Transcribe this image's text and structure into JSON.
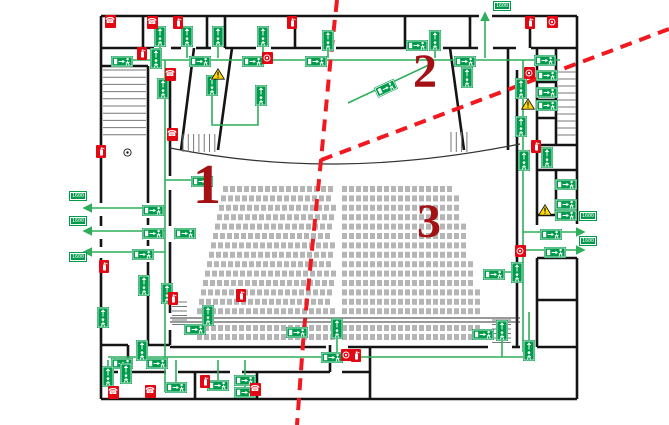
{
  "plan": {
    "title": "theater-evacuation-floor-plan",
    "colors": {
      "wall": "#141414",
      "route_green": "#2EAE5B",
      "sign_green": "#009B4A",
      "equipment_red": "#E30613",
      "section_red": "#F1191F",
      "zone_number_red": "#A31115",
      "seat_gray": "#B5B5B5",
      "warning_yellow": "#FFD800",
      "stair_gray": "#777777"
    },
    "zones": [
      {
        "label": "1",
        "x": 193,
        "y": 160,
        "size": 56
      },
      {
        "label": "2",
        "x": 413,
        "y": 50,
        "size": 48
      },
      {
        "label": "3",
        "x": 417,
        "y": 200,
        "size": 48
      }
    ],
    "width_labels": [
      {
        "text": "1600",
        "x": 70,
        "y": 192
      },
      {
        "text": "1600",
        "x": 70,
        "y": 217
      },
      {
        "text": "1600",
        "x": 70,
        "y": 253
      },
      {
        "text": "1600",
        "x": 580,
        "y": 212
      },
      {
        "text": "1600",
        "x": 580,
        "y": 237
      },
      {
        "text": "1600",
        "x": 494,
        "y": 2
      }
    ],
    "signs": {
      "horizontal": [
        [
          122,
          59
        ],
        [
          200,
          59
        ],
        [
          253,
          59
        ],
        [
          316,
          59
        ],
        [
          417,
          43
        ],
        [
          465,
          59
        ],
        [
          545,
          58
        ],
        [
          153,
          208
        ],
        [
          153,
          231
        ],
        [
          143,
          252
        ],
        [
          185,
          231
        ],
        [
          202,
          179
        ],
        [
          195,
          327
        ],
        [
          297,
          330
        ],
        [
          122,
          361
        ],
        [
          157,
          361
        ],
        [
          176,
          385
        ],
        [
          218,
          383
        ],
        [
          245,
          378
        ],
        [
          245,
          390
        ],
        [
          332,
          355
        ],
        [
          483,
          332
        ],
        [
          494,
          272
        ],
        [
          547,
          73
        ],
        [
          547,
          90
        ],
        [
          547,
          103
        ],
        [
          566,
          182
        ],
        [
          566,
          202
        ],
        [
          566,
          213
        ],
        [
          551,
          232
        ],
        [
          555,
          250
        ]
      ],
      "rotated": [
        {
          "x": 385,
          "y": 86,
          "rot": -25
        }
      ],
      "vertical": [
        [
          160,
          36
        ],
        [
          187,
          36
        ],
        [
          218,
          36
        ],
        [
          263,
          36
        ],
        [
          328,
          40
        ],
        [
          435,
          40
        ],
        [
          156,
          58
        ],
        [
          467,
          77
        ],
        [
          521,
          88
        ],
        [
          521,
          126
        ],
        [
          524,
          160
        ],
        [
          547,
          157
        ],
        [
          212,
          85
        ],
        [
          261,
          95
        ],
        [
          163,
          88
        ],
        [
          144,
          285
        ],
        [
          103,
          317
        ],
        [
          167,
          293
        ],
        [
          208,
          315
        ],
        [
          142,
          350
        ],
        [
          108,
          376
        ],
        [
          126,
          373
        ],
        [
          337,
          328
        ],
        [
          502,
          330
        ],
        [
          529,
          350
        ],
        [
          517,
          272
        ]
      ]
    },
    "icons": {
      "phone": [
        [
          110,
          21
        ],
        [
          152,
          22
        ],
        [
          170,
          74
        ],
        [
          172,
          134
        ],
        [
          113,
          392
        ],
        [
          150,
          391
        ],
        [
          255,
          389
        ]
      ],
      "extinguisher": [
        [
          178,
          22
        ],
        [
          292,
          22
        ],
        [
          142,
          53
        ],
        [
          101,
          151
        ],
        [
          104,
          266
        ],
        [
          173,
          298
        ],
        [
          241,
          295
        ],
        [
          356,
          355
        ],
        [
          530,
          22
        ],
        [
          536,
          146
        ],
        [
          205,
          381
        ]
      ],
      "alarm": [
        [
          267,
          58
        ],
        [
          529,
          73
        ],
        [
          552,
          22
        ],
        [
          520,
          251
        ],
        [
          346,
          355
        ]
      ],
      "warning": [
        [
          218,
          74
        ],
        [
          528,
          104
        ],
        [
          545,
          210
        ]
      ],
      "callpoint": [
        [
          127,
          152
        ]
      ]
    },
    "routes": [
      {
        "points": [
          [
            112,
            60
          ],
          [
            560,
            60
          ]
        ]
      },
      {
        "points": [
          [
            160,
            58
          ],
          [
            160,
            46
          ]
        ]
      },
      {
        "points": [
          [
            187,
            58
          ],
          [
            187,
            46
          ]
        ]
      },
      {
        "points": [
          [
            218,
            58
          ],
          [
            218,
            46
          ]
        ]
      },
      {
        "points": [
          [
            263,
            58
          ],
          [
            263,
            46
          ]
        ]
      },
      {
        "points": [
          [
            328,
            58
          ],
          [
            328,
            50
          ]
        ]
      },
      {
        "points": [
          [
            435,
            58
          ],
          [
            435,
            50
          ]
        ]
      },
      {
        "points": [
          [
            467,
            60
          ],
          [
            467,
            70
          ]
        ]
      },
      {
        "points": [
          [
            485,
            58
          ],
          [
            485,
            13
          ]
        ],
        "arrow": true
      },
      {
        "points": [
          [
            523,
            60
          ],
          [
            523,
            352
          ]
        ]
      },
      {
        "points": [
          [
            165,
            60
          ],
          [
            165,
            392
          ]
        ]
      },
      {
        "points": [
          [
            165,
            208
          ],
          [
            84,
            208
          ]
        ],
        "arrow": true
      },
      {
        "points": [
          [
            165,
            231
          ],
          [
            84,
            231
          ]
        ],
        "arrow": true
      },
      {
        "points": [
          [
            165,
            252
          ],
          [
            84,
            252
          ]
        ],
        "arrow": true
      },
      {
        "points": [
          [
            523,
            232
          ],
          [
            584,
            232
          ]
        ],
        "arrow": true
      },
      {
        "points": [
          [
            523,
            250
          ],
          [
            584,
            250
          ]
        ],
        "arrow": true
      },
      {
        "points": [
          [
            165,
            180
          ],
          [
            202,
            180
          ]
        ]
      },
      {
        "points": [
          [
            348,
            103
          ],
          [
            433,
            63
          ]
        ]
      },
      {
        "points": [
          [
            108,
            357
          ],
          [
            527,
            357
          ]
        ]
      },
      {
        "points": [
          [
            529,
            312
          ],
          [
            529,
            347
          ]
        ]
      },
      {
        "points": [
          [
            337,
            332
          ],
          [
            337,
            357
          ]
        ]
      },
      {
        "points": [
          [
            176,
            360
          ],
          [
            176,
            382
          ]
        ]
      },
      {
        "points": [
          [
            218,
            360
          ],
          [
            218,
            381
          ]
        ]
      },
      {
        "points": [
          [
            245,
            360
          ],
          [
            245,
            388
          ]
        ]
      },
      {
        "points": [
          [
            108,
            360
          ],
          [
            108,
            373
          ]
        ]
      },
      {
        "points": [
          [
            126,
            360
          ],
          [
            126,
            371
          ]
        ]
      },
      {
        "points": [
          [
            142,
            347
          ],
          [
            142,
            357
          ]
        ]
      },
      {
        "points": [
          [
            502,
            334
          ],
          [
            502,
            357
          ]
        ]
      },
      {
        "points": [
          [
            523,
            272
          ],
          [
            497,
            272
          ]
        ]
      },
      {
        "points": [
          [
            212,
            95
          ],
          [
            212,
            125
          ],
          [
            258,
            125
          ],
          [
            258,
            105
          ]
        ]
      }
    ],
    "section_lines": [
      {
        "points": [
          [
            337,
            0
          ],
          [
            331,
            55
          ],
          [
            321,
            160
          ],
          [
            313,
            240
          ],
          [
            304,
            330
          ],
          [
            297,
            425
          ]
        ]
      },
      {
        "points": [
          [
            321,
            160
          ],
          [
            669,
            29
          ]
        ]
      }
    ],
    "walls": [
      [
        101,
        16,
        479,
        16
      ],
      [
        492,
        16,
        577,
        16
      ],
      [
        101,
        16,
        101,
        203
      ],
      [
        101,
        216,
        101,
        226
      ],
      [
        101,
        239,
        101,
        247
      ],
      [
        101,
        258,
        101,
        399
      ],
      [
        577,
        16,
        577,
        224
      ],
      [
        577,
        258,
        577,
        399
      ],
      [
        101,
        399,
        577,
        399
      ],
      [
        101,
        48,
        154,
        48
      ],
      [
        171,
        48,
        181,
        48
      ],
      [
        196,
        48,
        211,
        48
      ],
      [
        225,
        48,
        256,
        48
      ],
      [
        271,
        48,
        321,
        48
      ],
      [
        336,
        48,
        428,
        48
      ],
      [
        443,
        48,
        478,
        48
      ],
      [
        493,
        48,
        516,
        48
      ],
      [
        531,
        48,
        577,
        48
      ],
      [
        143,
        16,
        143,
        48
      ],
      [
        207,
        16,
        207,
        48
      ],
      [
        225,
        16,
        225,
        48
      ],
      [
        295,
        16,
        295,
        48
      ],
      [
        405,
        16,
        405,
        48
      ],
      [
        470,
        16,
        470,
        48
      ],
      [
        530,
        16,
        530,
        48
      ],
      [
        101,
        66,
        148,
        66
      ],
      [
        148,
        66,
        148,
        143
      ],
      [
        148,
        143,
        148,
        203
      ],
      [
        148,
        218,
        148,
        225
      ],
      [
        148,
        240,
        148,
        246
      ],
      [
        148,
        262,
        148,
        345
      ],
      [
        170,
        70,
        170,
        176
      ],
      [
        170,
        190,
        170,
        226
      ],
      [
        170,
        242,
        170,
        288
      ],
      [
        170,
        304,
        170,
        313
      ],
      [
        170,
        330,
        170,
        345
      ],
      [
        194,
        48,
        181,
        150
      ],
      [
        232,
        48,
        218,
        150
      ],
      [
        450,
        48,
        464,
        150
      ],
      [
        508,
        48,
        508,
        150
      ],
      [
        517,
        70,
        517,
        266
      ],
      [
        517,
        282,
        517,
        347
      ],
      [
        170,
        347,
        326,
        347
      ],
      [
        348,
        347,
        488,
        347
      ],
      [
        512,
        347,
        520,
        347
      ],
      [
        537,
        347,
        577,
        347
      ],
      [
        537,
        48,
        537,
        225
      ],
      [
        537,
        258,
        537,
        347
      ],
      [
        537,
        82,
        556,
        82
      ],
      [
        537,
        100,
        556,
        100
      ],
      [
        537,
        118,
        556,
        118
      ],
      [
        556,
        48,
        556,
        145
      ],
      [
        537,
        145,
        577,
        145
      ],
      [
        537,
        170,
        577,
        170
      ],
      [
        556,
        170,
        556,
        215
      ],
      [
        537,
        215,
        577,
        215
      ],
      [
        537,
        258,
        577,
        258
      ],
      [
        537,
        300,
        577,
        300
      ],
      [
        101,
        345,
        128,
        345
      ],
      [
        140,
        345,
        170,
        345
      ],
      [
        101,
        372,
        118,
        372
      ],
      [
        130,
        372,
        166,
        372
      ],
      [
        178,
        372,
        230,
        372
      ],
      [
        242,
        372,
        330,
        372
      ],
      [
        342,
        372,
        370,
        372
      ],
      [
        128,
        345,
        128,
        372
      ],
      [
        195,
        372,
        195,
        399
      ],
      [
        257,
        372,
        257,
        399
      ],
      [
        370,
        347,
        370,
        399
      ],
      [
        330,
        345,
        330,
        372
      ]
    ],
    "thin_lines": [
      [
        170,
        318,
        520,
        318
      ],
      [
        170,
        322,
        520,
        322
      ]
    ],
    "stage_curve": "M170,148 C280,170 390,170 520,144",
    "stairs": [
      {
        "x": 103,
        "y": 70,
        "len": 43,
        "n": 10,
        "step": 7.2,
        "dir": "h"
      },
      {
        "x": 557,
        "y": 72,
        "len": 19,
        "n": 10,
        "step": 7,
        "dir": "h"
      },
      {
        "x": 183,
        "y": 134,
        "len": 18,
        "n": 7,
        "step": 5.3,
        "dir": "v"
      },
      {
        "x": 451,
        "y": 132,
        "len": 20,
        "n": 4,
        "step": 5.3,
        "dir": "v"
      },
      {
        "x": 172,
        "y": 302,
        "len": 15,
        "n": 6,
        "step": 4.5,
        "dir": "h"
      },
      {
        "x": 492,
        "y": 320,
        "len": 19,
        "n": 6,
        "step": 4.5,
        "dir": "h"
      }
    ],
    "seating": {
      "upper": {
        "rows": 14,
        "y_start": 186,
        "row_pitch": 9.4,
        "seat_w": 5,
        "seat_h": 6,
        "seat_pitch": 7,
        "left_block": {
          "x_right": 336,
          "width_start": 113,
          "width_step": 2
        },
        "right_block": {
          "x_left": 342,
          "width_start": 116,
          "width_step": 2.1
        }
      },
      "lower": {
        "rows": 2,
        "y_start": 325,
        "row_pitch": 9,
        "seat_w": 5,
        "seat_h": 6,
        "seat_pitch": 7,
        "left_block": {
          "x_left": 197,
          "x_right": 336
        },
        "right_block": {
          "x_left": 342,
          "x_right": 486
        }
      }
    }
  }
}
